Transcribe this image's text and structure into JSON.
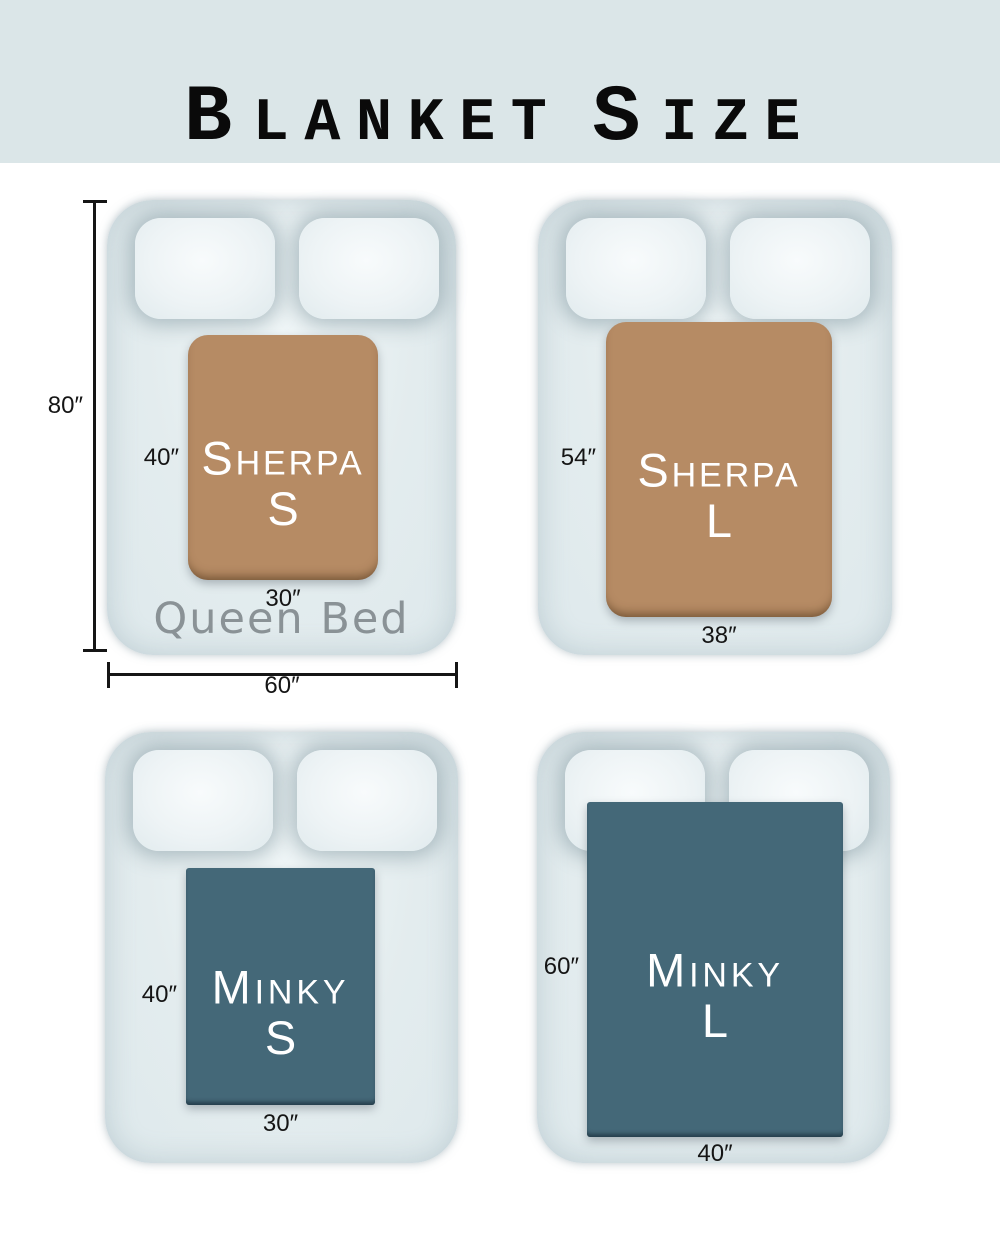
{
  "header": {
    "word1_initial": "B",
    "word1_rest": "LANKET",
    "word2_initial": "S",
    "word2_rest": "IZE"
  },
  "queen_bed": {
    "label": "Queen Bed",
    "height_label": "80″",
    "width_label": "60″"
  },
  "blankets": [
    {
      "name_initial": "S",
      "name_rest": "HERPA",
      "size_letter": "S",
      "height_label": "40″",
      "width_label": "30″"
    },
    {
      "name_initial": "S",
      "name_rest": "HERPA",
      "size_letter": "L",
      "height_label": "54″",
      "width_label": "38″"
    },
    {
      "name_initial": "M",
      "name_rest": "INKY",
      "size_letter": "S",
      "height_label": "40″",
      "width_label": "30″"
    },
    {
      "name_initial": "M",
      "name_rest": "INKY",
      "size_letter": "L",
      "height_label": "60″",
      "width_label": "40″"
    }
  ],
  "colors": {
    "header_bg": "#dbe6e8",
    "bed": "#e3ecee",
    "pillow": "#edf3f5",
    "sherpa": "#b68b64",
    "minky": "#446878",
    "blanket_text": "#ffffff",
    "queen_label": "#8a9296",
    "dimension": "#151515"
  }
}
